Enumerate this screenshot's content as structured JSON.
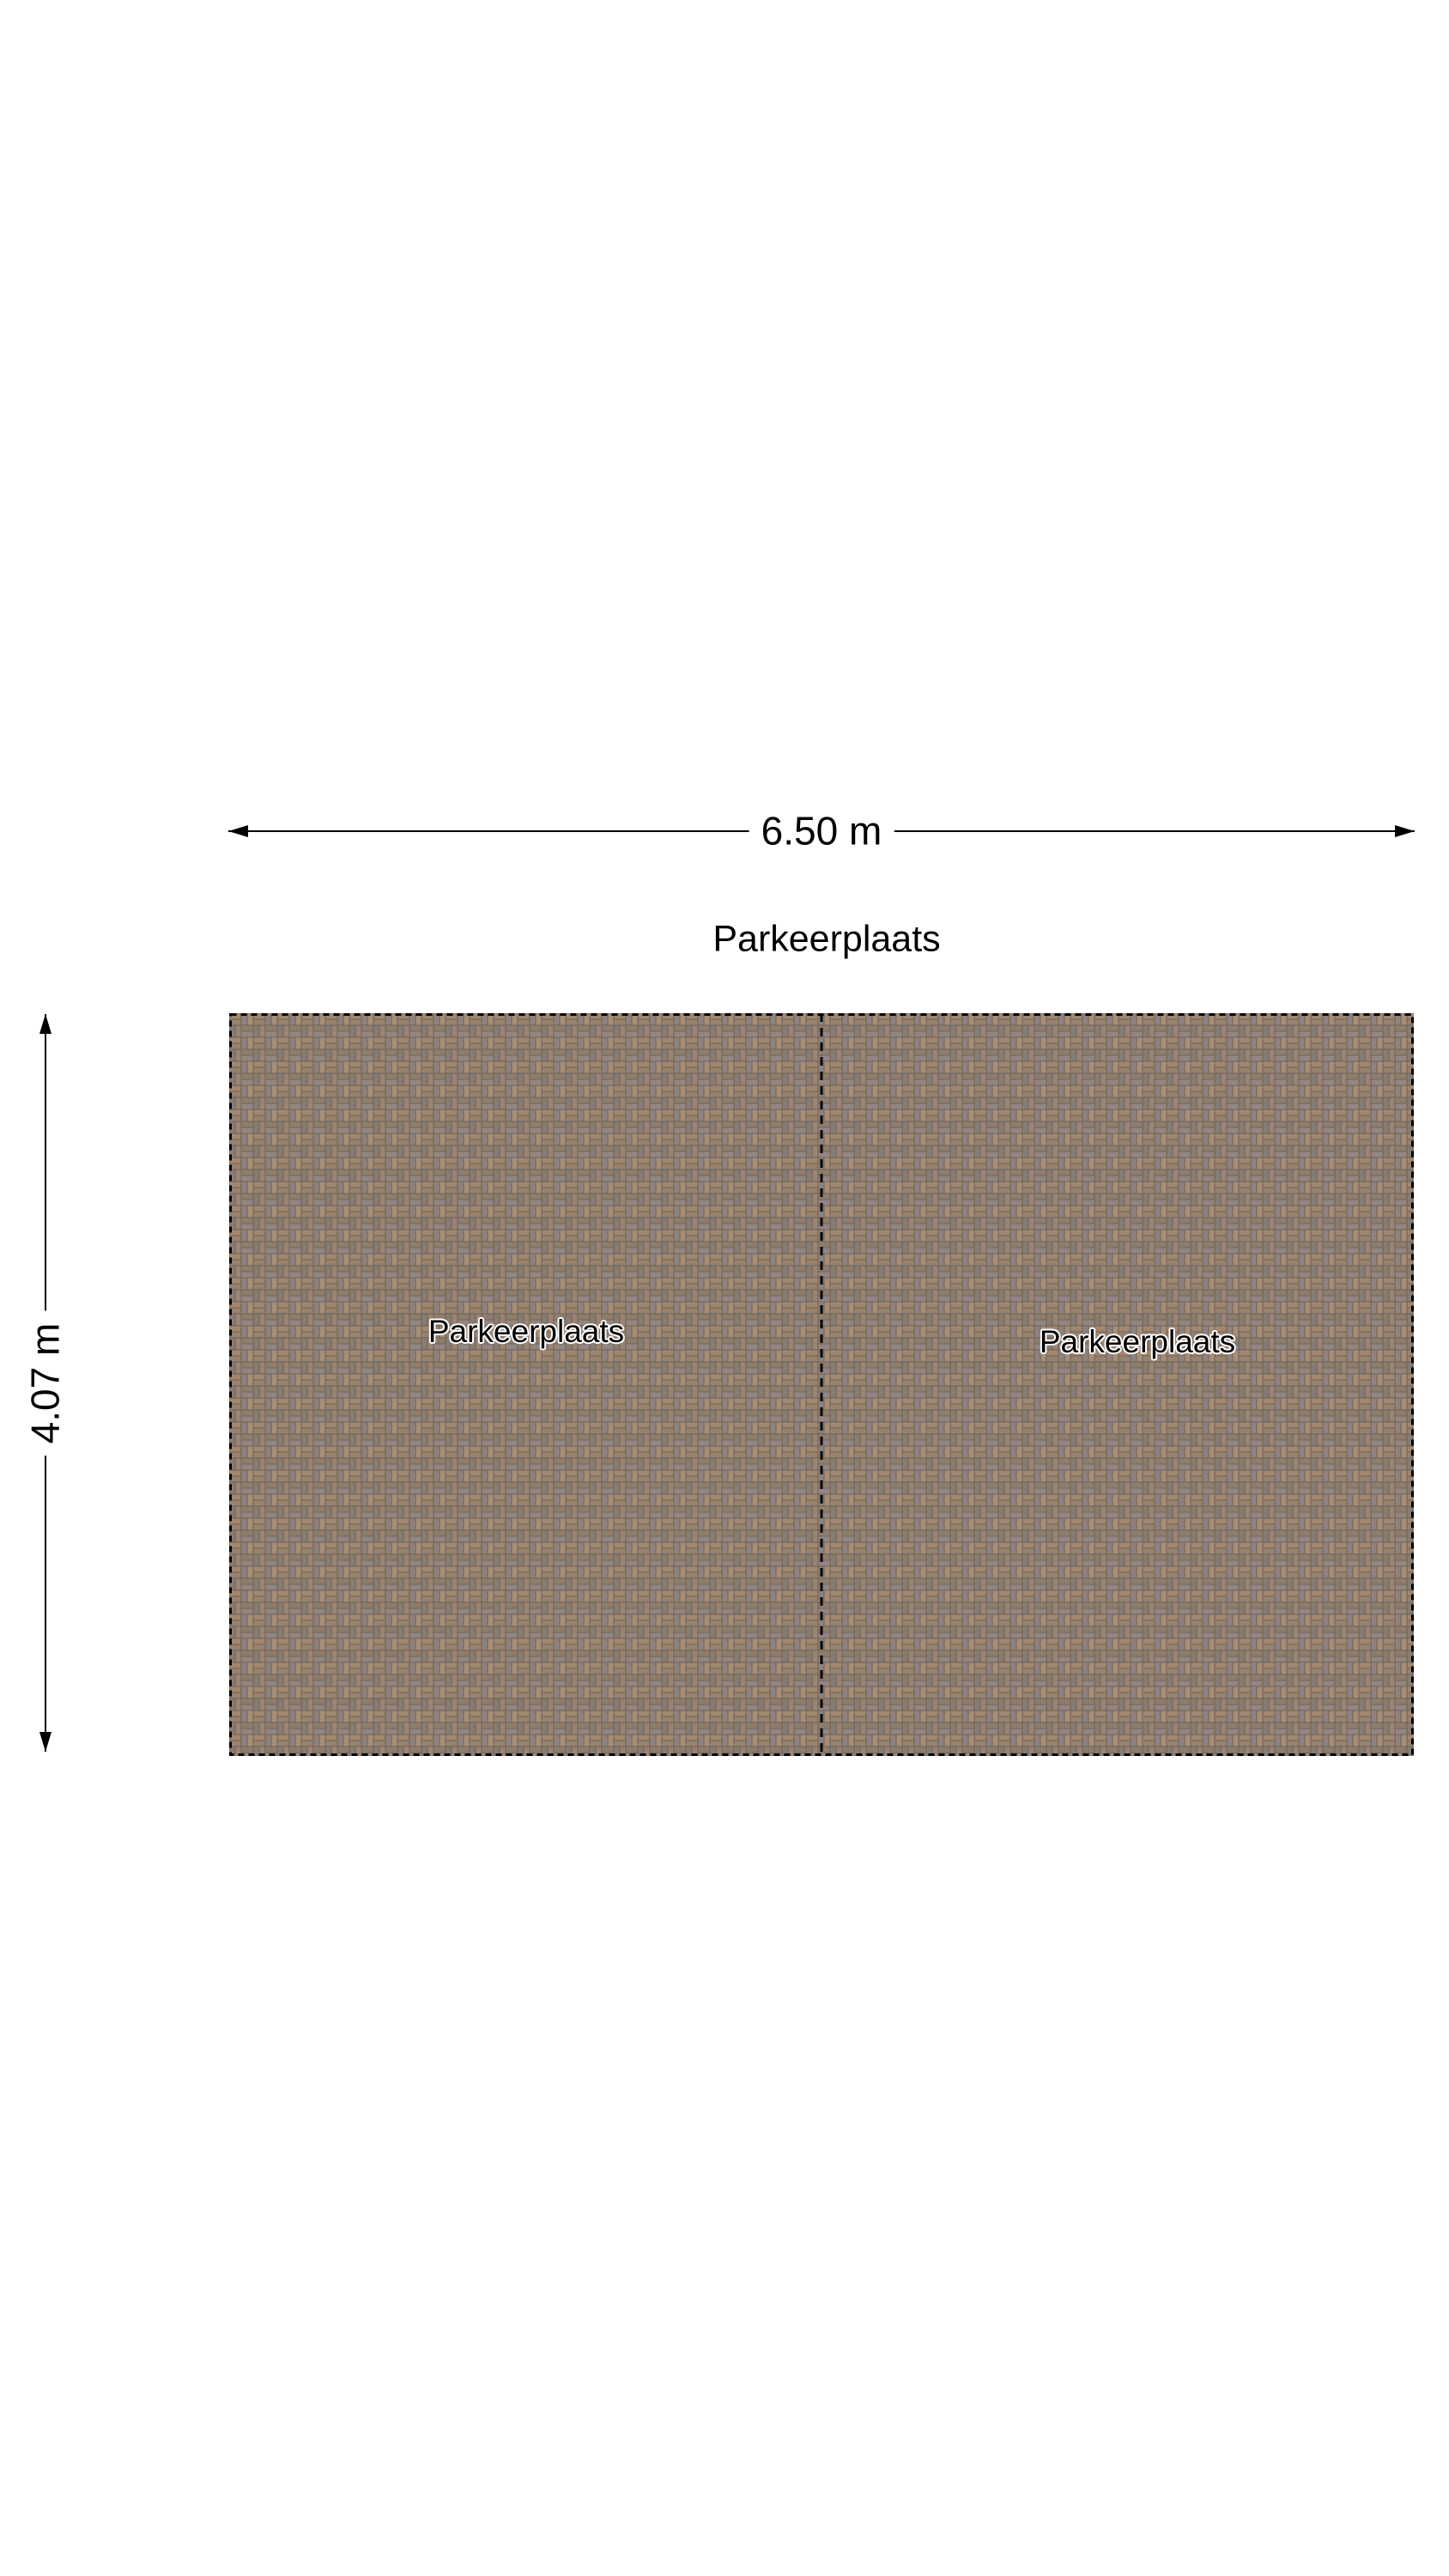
{
  "title": "Parkeerplaats",
  "dimensions": {
    "width_label": "6.50 m",
    "height_label": "4.07 m"
  },
  "parking_spaces": [
    {
      "label": "Parkeerplaats"
    },
    {
      "label": "Parkeerplaats"
    }
  ],
  "colors": {
    "line": "#000000",
    "label_text": "#000000",
    "label_halo": "#ffffff",
    "grout": "#6d6259",
    "brick1": "#a2866e",
    "brick2": "#97816f",
    "brick3": "#8d827d",
    "brick4": "#a88d75",
    "brick5": "#867c74",
    "brick6": "#9c8372",
    "brick7": "#8f7d6c",
    "brick8": "#938680"
  }
}
